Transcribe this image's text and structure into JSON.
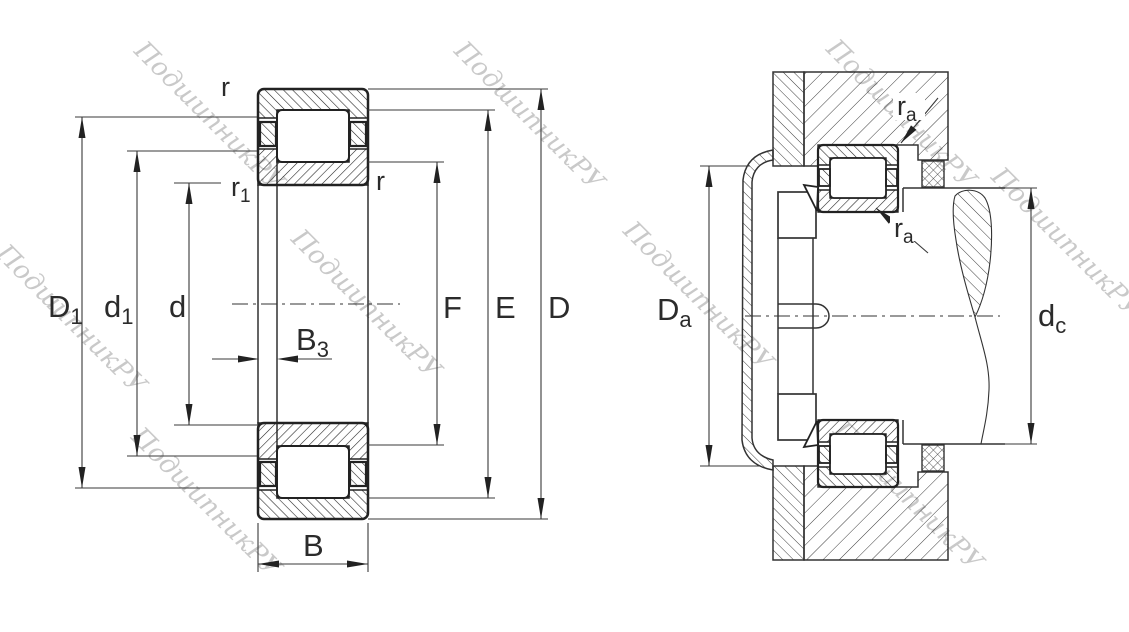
{
  "page": {
    "title": "Cylindrical roller bearing dimension drawing"
  },
  "watermark": {
    "text": "ПодшипникРУ",
    "color": "#c9c9c9"
  },
  "colors": {
    "line": "#222222",
    "dimension_line": "#3a3a3a",
    "background": "#ffffff",
    "watermark": "#c9c9c9"
  },
  "left_view": {
    "name": "bearing-cross-section",
    "labels": {
      "r_top": {
        "main": "r",
        "sub": ""
      },
      "r1": {
        "main": "r",
        "sub": "1"
      },
      "r_right": {
        "main": "r",
        "sub": ""
      },
      "D1": {
        "main": "D",
        "sub": "1"
      },
      "d1": {
        "main": "d",
        "sub": "1"
      },
      "d": {
        "main": "d",
        "sub": ""
      },
      "B3": {
        "main": "B",
        "sub": "3"
      },
      "B": {
        "main": "B",
        "sub": ""
      },
      "F": {
        "main": "F",
        "sub": ""
      },
      "E": {
        "main": "E",
        "sub": ""
      },
      "D": {
        "main": "D",
        "sub": ""
      }
    }
  },
  "right_view": {
    "name": "mounted-bearing-arrangement",
    "labels": {
      "ra_top": {
        "main": "r",
        "sub": "a"
      },
      "ra_bottom": {
        "main": "r",
        "sub": "a"
      },
      "Da": {
        "main": "D",
        "sub": "a"
      },
      "dc": {
        "main": "d",
        "sub": "c"
      }
    }
  }
}
